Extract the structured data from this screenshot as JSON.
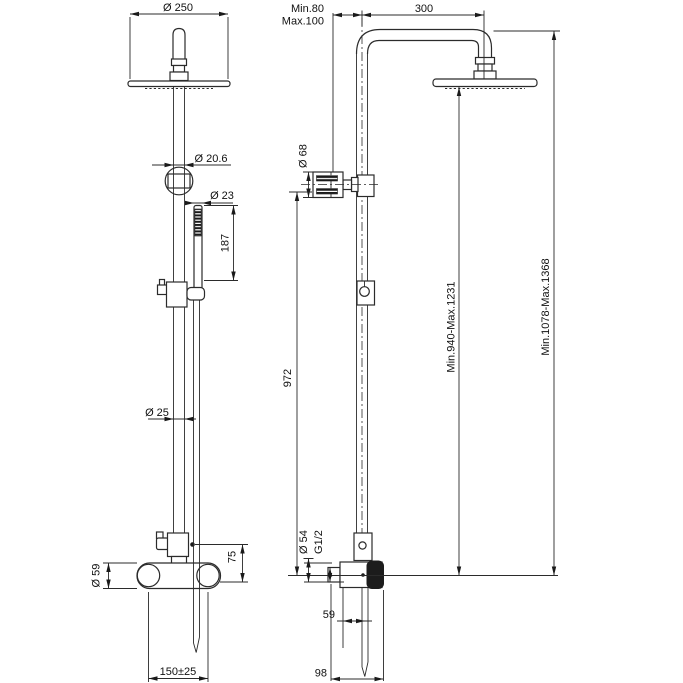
{
  "drawing": {
    "type": "technical-dimension-drawing",
    "subject": "shower column with overhead shower, hand shower and wall mixer (front and side views)",
    "line_color": "#2b2b2b",
    "front_view": {
      "head_diameter": "Ø 250",
      "pipe_top_diameter": "Ø 20.6",
      "handshower_diameter": "Ø 23",
      "handshower_length": "187",
      "pipe_diameter": "Ø 25",
      "mixer_diameter": "Ø 59",
      "diverter_offset": "75",
      "inlet_spacing": "150±25"
    },
    "side_view": {
      "wall_min": "Min.80",
      "wall_max": "Max.100",
      "arm_reach": "300",
      "holder_diameter": "Ø 68",
      "column_height": "972",
      "head_height_range": "Min.940-Max.1231",
      "total_height_range": "Min.1078-Max.1368",
      "escutcheon_diameter": "Ø 54",
      "thread_size": "G1/2",
      "hose_offset": "59",
      "mixer_depth": "98"
    }
  }
}
